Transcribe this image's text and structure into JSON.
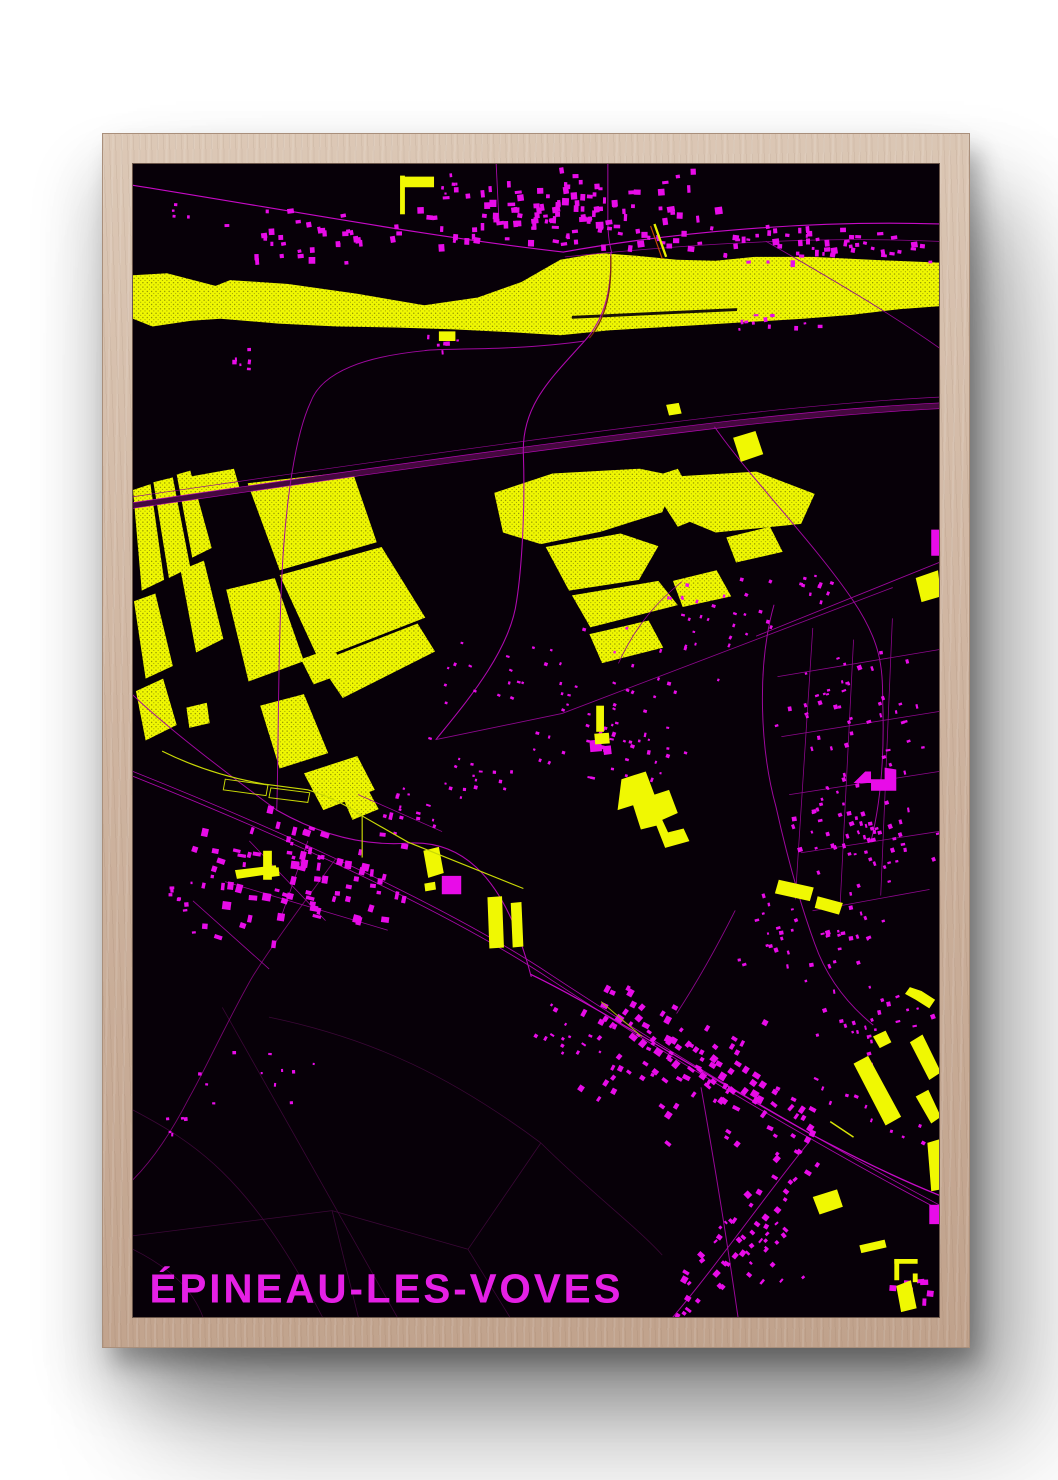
{
  "title": {
    "text": "ÉPINEAU-LES-VOVES"
  },
  "palette": {
    "poster_background": "#070008",
    "frame_wood": "#cfb5a1",
    "map_yellow": "#f0f802",
    "yellow_path": "#c9d806",
    "bridge_orange": "#c24a00",
    "building_magenta": "#e80ce8",
    "road_bright": "#c60ac6",
    "road_mid": "#a008a0",
    "road_dim": "#8e078e",
    "road_faint": "#3c0738",
    "motorway_band": "#45083f",
    "railway": "#ad08ad",
    "title_magenta": "#e520e5"
  },
  "map": {
    "river": {
      "outline": "0,115 35,113 85,126 100,120 160,124 230,134 300,146 355,138 400,122 440,99 480,92 520,95 560,99 600,100 640,96 700,96 760,99 830,102 830,147 790,150 740,156 690,160 640,163 590,166 540,169 490,172 440,177 390,174 330,171 270,169 210,168 150,165 90,160 60,162 20,168 0,160",
      "slit": "452,157 622,149 622,152 452,160"
    },
    "fields": [
      "0,337 18,331 32,430 9,441",
      "21,329 41,324 59,417 37,428",
      "45,321 59,317 81,397 61,407",
      "1,452 23,444 41,519 13,532",
      "49,420 73,410 93,491 65,505",
      "3,545 31,532 45,580 13,596",
      "60,323 104,315 110,336 66,344",
      "118,330 226,318 251,391 151,420",
      "151,425 256,396 301,469 191,512",
      "96,440 146,428 176,514 119,535",
      "191,515 293,475 311,504 216,552",
      "131,560 176,548 201,609 151,625",
      "176,630 231,612 249,647 196,668",
      "55,562 76,557 79,578 58,583",
      "173,512 206,500 221,525 186,538",
      "216,655 241,645 253,667 226,678",
      "372,340 432,320 522,315 560,323 545,360 482,380 420,393 381,381",
      "560,323 642,318 702,341 688,372 600,381 552,361",
      "425,396 502,382 541,395 521,430 449,441",
      "452,446 541,431 561,456 471,479",
      "470,486 531,472 546,500 483,516",
      "556,431 601,420 616,447 566,458",
      "611,386 656,375 669,401 621,412",
      "537,323 561,315 574,338 588,332 598,360 561,375 545,350"
    ],
    "yellow_solids": [
      "275,12 280,12 280,52 275,52",
      "279,13 310,13 310,24 279,24",
      "315,173 332,173 332,183 315,183",
      "549,249 562,247 565,258 552,260",
      "618,283 641,276 649,300 626,308",
      "806,428 829,420 832,447 812,453",
      "503,636 528,628 537,652 552,647 561,671 545,678 551,691 567,687 573,700 548,707 539,684 523,688 515,663 499,668",
      "365,758 380,757 382,810 367,811",
      "389,764 400,763 402,809 391,810",
      "477,560 485,560 485,587 477,587",
      "475,589 490,588 491,599 476,600",
      "134,710 143,710 143,740 134,740",
      "134,729 150,727 151,736 135,738",
      "105,730 147,725 149,733 107,739",
      "299,710 315,706 320,733 304,738",
      "300,744 311,742 312,750 301,752",
      "742,930 757,922 791,985 775,994",
      "800,908 813,900 832,939 820,947",
      "806,964 819,957 832,985 822,992",
      "762,902 775,896 781,908 769,914",
      "665,740 701,748 697,762 661,754",
      "705,757 731,764 727,776 702,769",
      "700,1068 725,1060 731,1078 707,1086",
      "800,851 812,855 826,864 820,873 806,864 795,858",
      "818,1012 831,1008 832,1060 822,1062",
      "784,1132 808,1132 808,1137 784,1137",
      "784,1132 789,1132 789,1154 784,1154",
      "803,1147 808,1147 808,1156 803,1156",
      "786,1160 801,1154 807,1183 791,1187",
      "748,1118 774,1112 776,1120 750,1126"
    ],
    "yellow_paths": [
      {
        "d": "M537,62 L549,96",
        "c": "#e8ef00",
        "w": 2.4
      },
      {
        "d": "M533,64 L545,98",
        "c": "#c24a00",
        "w": 1.2
      },
      {
        "d": "M30,607 C60,622 95,634 135,641 L180,647 C205,655 222,664 236,674 L283,701 L402,749",
        "c": "#c9d806",
        "w": 1.2
      },
      {
        "d": "M236,674 L236,717",
        "c": "#c9d806",
        "w": 1.2
      },
      {
        "d": "M95,636 l44,6 -2,11 -44,-6 z",
        "c": "#c9d806",
        "w": 1
      },
      {
        "d": "M142,645 l40,5 -2,10 -40,-5 z",
        "c": "#c9d806",
        "w": 1
      },
      {
        "d": "M482,866 L524,902",
        "c": "#a8b806",
        "w": 1
      },
      {
        "d": "M718,990 L742,1006",
        "c": "#d8e406",
        "w": 1.5
      }
    ],
    "motorway": {
      "band": "M0,353 C180,327 400,294 620,268 C700,259 770,253 830,250",
      "band_w": 6,
      "edges": [
        "M0,350 C180,324 400,291 620,265 C700,256 770,250 830,247",
        "M0,356 C180,330 400,297 620,271 C700,262 770,256 830,253"
      ],
      "companion": "M0,344 C180,318 400,285 620,259 C700,250 770,244 830,241"
    },
    "railway": [
      "M0,633 C160,697 330,776 430,843 C560,929 710,1017 830,1081",
      "M0,628 C160,692 330,771 430,838 C560,924 710,1012 830,1076"
    ],
    "bridge_over_river": "M492,95 C493,130 488,158 470,180",
    "faint_roads": [
      "M92,872 L272,1192",
      "M0,978 C60,1010 120,1045 195,1192",
      "M140,882 C250,905 330,945 420,1012",
      "M0,1108 L205,1082 L345,1122",
      "M205,1082 L232,1192",
      "M345,1122 L388,1192",
      "M345,1122 L420,1012",
      "M420,1012 C470,1062 520,1100 545,1128",
      "M0,1122 C40,1142 62,1165 72,1192"
    ],
    "roads": [
      {
        "d": "M0,22 C150,46 310,76 443,91",
        "w": 1.2,
        "c": "#c60ac6"
      },
      {
        "d": "M443,91 C560,70 700,58 830,62",
        "w": 1.2,
        "c": "#c60ac6"
      },
      {
        "d": "M445,96 C560,84 700,74 830,80",
        "w": 0.8,
        "c": "#8e078e"
      },
      {
        "d": "M489,0 L489,58 C489,75 491,84 493,92",
        "w": 1,
        "c": "#a909a9"
      },
      {
        "d": "M374,0 L377,62",
        "w": 0.9,
        "c": "#a909a9"
      },
      {
        "d": "M492,92 C493,130 486,160 465,183 C430,222 400,250 402,300 C404,360 400,420 395,452 C388,505 340,560 312,595",
        "w": 1.1,
        "c": "#b009b0"
      },
      {
        "d": "M465,183 C390,194 310,190 300,193 C240,199 195,214 183,246 C168,278 157,345 153,432 C149,525 150,605 148,668",
        "w": 1,
        "c": "#a008a0"
      },
      {
        "d": "M0,549 C30,578 90,625 148,668",
        "w": 1,
        "c": "#a008a0"
      },
      {
        "d": "M148,668 C190,692 235,706 285,702 C330,700 380,724 410,840",
        "w": 1.1,
        "c": "#b009b0"
      },
      {
        "d": "M410,838 C480,872 560,925 700,1004 C760,1036 800,1054 830,1066",
        "w": 1.3,
        "c": "#c60ac6"
      },
      {
        "d": "M585,955 C600,1040 612,1115 623,1192",
        "w": 1,
        "c": "#9a079a"
      },
      {
        "d": "M697,1010 C650,1068 600,1140 556,1192",
        "w": 1,
        "c": "#a008a0"
      },
      {
        "d": "M599,272 C640,330 700,390 742,452 C770,494 772,520 772,554 C774,610 770,660 760,700",
        "w": 1,
        "c": "#a008a0"
      },
      {
        "d": "M642,488 L830,412",
        "w": 0.9,
        "c": "#9a079a"
      },
      {
        "d": "M312,595 L442,568 L782,438",
        "w": 0.9,
        "c": "#8e078e"
      },
      {
        "d": "M500,516 C520,472 545,448 565,432",
        "w": 0.8,
        "c": "#8e078e"
      },
      {
        "d": "M652,80 C730,125 785,158 830,190",
        "w": 0.9,
        "c": "#8e078e"
      },
      {
        "d": "M660,456 C642,520 646,606 662,664 C674,718 686,762 702,806 C716,846 740,872 762,890",
        "w": 1,
        "c": "#a008a0"
      },
      {
        "d": "M560,878 C586,838 606,800 620,772",
        "w": 0.9,
        "c": "#8e078e"
      },
      {
        "d": "M209,718 C175,765 140,812 122,842 C95,890 75,935 58,965 C40,1000 20,1030 0,1050",
        "w": 0.9,
        "c": "#7a0674"
      },
      {
        "d": "M700,480 L682,760",
        "w": 0.8,
        "c": "#8e078e"
      },
      {
        "d": "M742,492 L728,770",
        "w": 0.8,
        "c": "#8e078e"
      },
      {
        "d": "M782,470 L770,756",
        "w": 0.8,
        "c": "#8e078e"
      },
      {
        "d": "M664,530 L830,502",
        "w": 0.8,
        "c": "#8e078e"
      },
      {
        "d": "M668,592 L830,566",
        "w": 0.8,
        "c": "#8e078e"
      },
      {
        "d": "M676,652 L830,628",
        "w": 0.8,
        "c": "#8e078e"
      },
      {
        "d": "M688,712 L830,690",
        "w": 0.8,
        "c": "#8e078e"
      },
      {
        "d": "M700,772 L820,750",
        "w": 0.8,
        "c": "#8e078e"
      },
      {
        "d": "M95,742 L262,792",
        "w": 0.8,
        "c": "#9a079a"
      },
      {
        "d": "M120,700 L198,782",
        "w": 0.8,
        "c": "#9a079a"
      },
      {
        "d": "M62,762 L140,832",
        "w": 0.8,
        "c": "#9a079a"
      },
      {
        "d": "M180,700 L152,780",
        "w": 0.8,
        "c": "#9a079a"
      },
      {
        "d": "M232,652 L318,690",
        "w": 0.8,
        "c": "#9a079a"
      }
    ],
    "clusters": [
      {
        "cx": 455,
        "cy": 48,
        "w": 330,
        "h": 88,
        "n": 95,
        "s": [
          3,
          8
        ],
        "a": -3
      },
      {
        "cx": 185,
        "cy": 72,
        "w": 230,
        "h": 72,
        "n": 34,
        "s": [
          3,
          7
        ],
        "a": -5
      },
      {
        "cx": 720,
        "cy": 85,
        "w": 220,
        "h": 52,
        "n": 30,
        "s": [
          3,
          7
        ],
        "a": -4
      },
      {
        "cx": 660,
        "cy": 162,
        "w": 170,
        "h": 28,
        "n": 11,
        "s": [
          2,
          5
        ],
        "a": -4
      },
      {
        "cx": 112,
        "cy": 200,
        "w": 44,
        "h": 36,
        "n": 6,
        "s": [
          2,
          5
        ],
        "a": 0
      },
      {
        "cx": 318,
        "cy": 186,
        "w": 42,
        "h": 38,
        "n": 7,
        "s": [
          2,
          5
        ],
        "a": 0
      },
      {
        "cx": 50,
        "cy": 55,
        "w": 34,
        "h": 30,
        "n": 4,
        "s": [
          2,
          4
        ],
        "a": 0
      },
      {
        "cx": 325,
        "cy": 22,
        "w": 34,
        "h": 22,
        "n": 5,
        "s": [
          2,
          4
        ],
        "a": 0
      },
      {
        "cx": 480,
        "cy": 545,
        "w": 370,
        "h": 210,
        "n": 60,
        "s": [
          2,
          4
        ],
        "a": 20
      },
      {
        "cx": 505,
        "cy": 612,
        "w": 130,
        "h": 95,
        "n": 26,
        "s": [
          2,
          5
        ],
        "a": 15
      },
      {
        "cx": 610,
        "cy": 468,
        "w": 170,
        "h": 95,
        "n": 24,
        "s": [
          2,
          4
        ],
        "a": 20
      },
      {
        "cx": 705,
        "cy": 438,
        "w": 90,
        "h": 60,
        "n": 10,
        "s": [
          2,
          4
        ],
        "a": 15
      },
      {
        "cx": 350,
        "cy": 640,
        "w": 120,
        "h": 70,
        "n": 14,
        "s": [
          2,
          4
        ],
        "a": 10
      },
      {
        "cx": 178,
        "cy": 738,
        "w": 250,
        "h": 155,
        "n": 85,
        "s": [
          3,
          9
        ],
        "a": 12
      },
      {
        "cx": 280,
        "cy": 668,
        "w": 110,
        "h": 60,
        "n": 14,
        "s": [
          2,
          5
        ],
        "a": 15
      },
      {
        "cx": 42,
        "cy": 762,
        "w": 75,
        "h": 85,
        "n": 9,
        "s": [
          2,
          5
        ],
        "a": 0
      },
      {
        "cx": 742,
        "cy": 560,
        "w": 180,
        "h": 120,
        "n": 42,
        "s": [
          2,
          5
        ],
        "a": -15
      },
      {
        "cx": 745,
        "cy": 688,
        "w": 180,
        "h": 155,
        "n": 66,
        "s": [
          2,
          5
        ],
        "a": -15
      },
      {
        "cx": 700,
        "cy": 805,
        "w": 160,
        "h": 120,
        "n": 38,
        "s": [
          2,
          5
        ],
        "a": -15
      },
      {
        "cx": 762,
        "cy": 888,
        "w": 140,
        "h": 95,
        "n": 26,
        "s": [
          2,
          5
        ],
        "a": -15
      },
      {
        "cx": 565,
        "cy": 940,
        "w": 230,
        "h": 170,
        "n": 55,
        "s": [
          3,
          7
        ],
        "a": 33
      },
      {
        "cx": 645,
        "cy": 1118,
        "w": 130,
        "h": 105,
        "n": 22,
        "s": [
          2,
          6
        ],
        "a": -45
      },
      {
        "cx": 800,
        "cy": 1162,
        "w": 70,
        "h": 55,
        "n": 8,
        "s": [
          4,
          9
        ],
        "a": 0
      },
      {
        "cx": 448,
        "cy": 898,
        "w": 90,
        "h": 70,
        "n": 14,
        "s": [
          2,
          5
        ],
        "a": 30
      },
      {
        "cx": 125,
        "cy": 940,
        "w": 170,
        "h": 95,
        "n": 11,
        "s": [
          2,
          4
        ],
        "a": 0
      },
      {
        "cx": 62,
        "cy": 992,
        "w": 70,
        "h": 45,
        "n": 5,
        "s": [
          2,
          4
        ],
        "a": 0
      }
    ],
    "rows": [
      {
        "x1": 300,
        "y1": 62,
        "x2": 625,
        "y2": 80,
        "n": 36,
        "j": 16,
        "s": [
          3,
          7
        ]
      },
      {
        "x1": 625,
        "y1": 78,
        "x2": 830,
        "y2": 95,
        "n": 22,
        "j": 10,
        "s": [
          2,
          6
        ]
      },
      {
        "x1": 478,
        "y1": 860,
        "x2": 700,
        "y2": 1004,
        "n": 62,
        "j": 24,
        "s": [
          3,
          8
        ]
      },
      {
        "x1": 695,
        "y1": 1012,
        "x2": 560,
        "y2": 1186,
        "n": 40,
        "j": 22,
        "s": [
          3,
          7
        ]
      },
      {
        "x1": 700,
        "y1": 955,
        "x2": 828,
        "y2": 1012,
        "n": 13,
        "j": 10,
        "s": [
          2,
          5
        ]
      }
    ],
    "blobs": [
      "822,378 832,378 832,405 822,405",
      "742,640 754,628 760,628 760,636 774,636 774,624 786,626 786,648 760,648 760,640",
      "318,736 338,736 338,755 318,755",
      "820,1076 832,1076 832,1096 820,1096",
      "470,596 482,595 483,607 471,608",
      "484,602 492,601 493,610 485,611"
    ]
  }
}
